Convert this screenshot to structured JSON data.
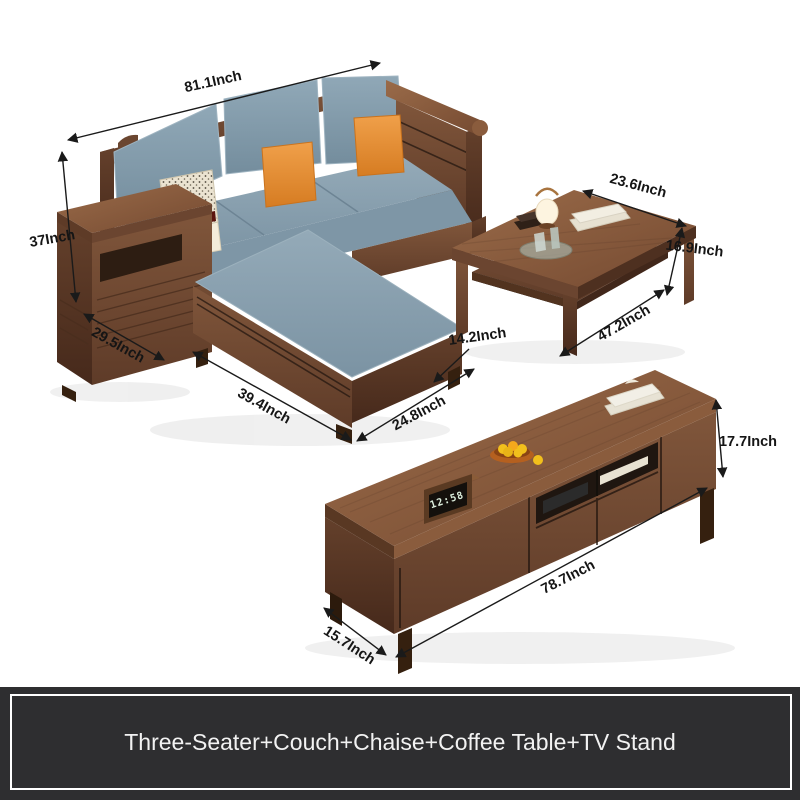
{
  "banner": {
    "text": "Three-Seater+Couch+Chaise+Coffee Table+TV Stand"
  },
  "sofa": {
    "label": "three-seater wood sofa with storage armrest and chaise",
    "dims": {
      "width": "81.1Inch",
      "height": "37Inch",
      "arm_depth": "29.5Inch",
      "chaise_length": "39.4Inch",
      "chaise_width": "24.8Inch",
      "base_height": "14.2Inch"
    }
  },
  "coffee_table": {
    "label": "coffee table",
    "dims": {
      "depth": "23.6Inch",
      "height": "16.9Inch",
      "length": "47.2Inch"
    }
  },
  "tv_stand": {
    "label": "TV stand",
    "dims": {
      "height": "17.7Inch",
      "length": "78.7Inch",
      "depth": "15.7Inch"
    }
  },
  "clock": {
    "time": "12:58"
  },
  "colors": {
    "wood": "#7a4f36",
    "wood_dark": "#553624",
    "cushion_blue": "#87a0af",
    "pillow_orange": "#e8913a",
    "banner_bg": "#2e2e30",
    "banner_text": "#f2f2f2",
    "label_text": "#151515",
    "background": "#ffffff"
  }
}
